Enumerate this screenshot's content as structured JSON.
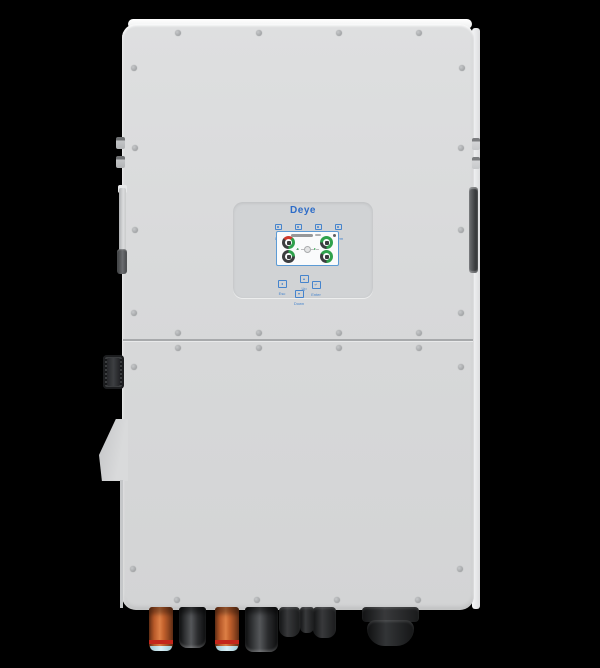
{
  "panel": {
    "logo": "Deye",
    "indicators": [
      {
        "label": "DC"
      },
      {
        "label": "AC"
      },
      {
        "label": "Normal"
      },
      {
        "label": "Alarm"
      }
    ],
    "buttons": [
      {
        "label": "Esc",
        "glyph": "◂"
      },
      {
        "label": "Up",
        "glyph": "▴"
      },
      {
        "label": "Down",
        "glyph": "▾"
      },
      {
        "label": "Enter",
        "glyph": "↵"
      }
    ]
  },
  "colors": {
    "body": "#d8d9da",
    "panel": "#d1d3d5",
    "logo_blue": "#2d6cc8",
    "label_blue": "#4584cd",
    "screen_border": "#5c9bd5",
    "gauge_green": "#2fa14c",
    "gauge_red": "#cf3a2c",
    "gauge_dark": "#3c3d3f",
    "connector_orange": "#c9662f",
    "connector_black": "#1d1e20",
    "background": "#000000"
  }
}
